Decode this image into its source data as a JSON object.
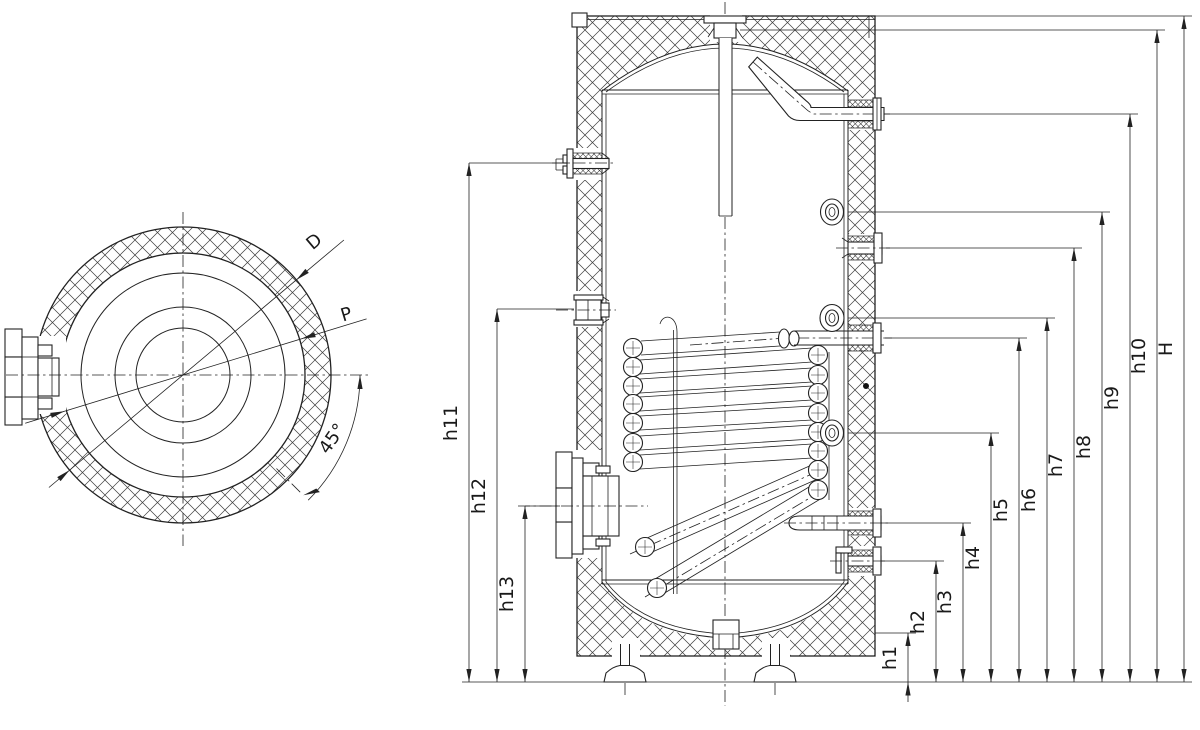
{
  "drawing": {
    "kind": "technical-drawing",
    "subject": "insulated hot water storage tank with internal heat-exchanger coil, top view and sectional front view",
    "colors": {
      "line": "#222222",
      "background": "#ffffff"
    }
  },
  "top_view": {
    "diameter_label": "D",
    "port_label": "P",
    "angle_label": "45°"
  },
  "dimensions": {
    "left": [
      {
        "id": "h11",
        "label": "h11"
      },
      {
        "id": "h12",
        "label": "h12"
      },
      {
        "id": "h13",
        "label": "h13"
      }
    ],
    "right": [
      {
        "id": "h1",
        "label": "h1"
      },
      {
        "id": "h2",
        "label": "h2"
      },
      {
        "id": "h3",
        "label": "h3"
      },
      {
        "id": "h4",
        "label": "h4"
      },
      {
        "id": "h5",
        "label": "h5"
      },
      {
        "id": "h6",
        "label": "h6"
      },
      {
        "id": "h7",
        "label": "h7"
      },
      {
        "id": "h8",
        "label": "h8"
      },
      {
        "id": "h9",
        "label": "h9"
      },
      {
        "id": "h10",
        "label": "h10"
      },
      {
        "id": "overall_height",
        "label": "H"
      }
    ]
  }
}
